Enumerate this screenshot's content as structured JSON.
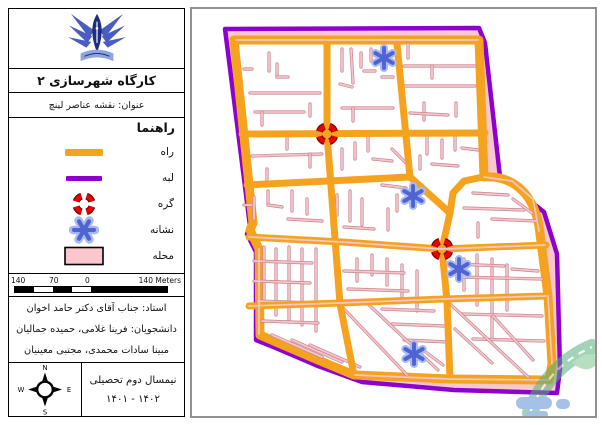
{
  "panel": {
    "title": "کارگاه شهرسازی ۲",
    "subtitle": "عنوان: نقشه عناصر لینچ",
    "legend": {
      "title": "راهنما",
      "items": [
        {
          "id": "road",
          "label": "راه"
        },
        {
          "id": "edge",
          "label": "لبه"
        },
        {
          "id": "node",
          "label": "گره"
        },
        {
          "id": "landmark",
          "label": "نشانه"
        },
        {
          "id": "district",
          "label": "محله"
        }
      ]
    },
    "scalebar": {
      "labels": [
        "140",
        "70",
        "0"
      ],
      "right_label": "140 Meters"
    },
    "credits": {
      "professor": "استاد: جناب آقای دکتر حامد اخوان",
      "students_line1": "دانشجویان: فرینا غلامی، حمیده جمالیان",
      "students_line2": "مبینا سادات محمدی، مجتبی معینیان"
    },
    "compass": {
      "n": "N",
      "s": "S",
      "e": "E",
      "w": "W"
    },
    "semester": {
      "line1": "نیمسال دوم تحصیلی",
      "line2": "۱۴۰۲ - ۱۴۰۱"
    }
  },
  "colors": {
    "road": "#F5A31F",
    "edge": "#8E00CE",
    "node_red": "#E60404",
    "node_dark": "#7A0000",
    "landmark_blue": "#4F63D2",
    "landmark_halo": "#A9BBF2",
    "district_pink": "#FAC7CD",
    "street_dark": "#C9848D",
    "street_light": "#F4C6CB",
    "logo_blue": "#4A5CC0",
    "logo_navy": "#1D2F7C",
    "logo_light": "#8FA3E0"
  },
  "map": {
    "boundary_d": "M 33,20 L 287,19 L 293,34 L 308,168 L 352,203 L 365,245 L 368,360 L 365,384 L 262,381 L 170,373 L 126,357 L 84,339 L 64,331 L 64,243 L 55,225 L 58,217 Z",
    "inner_d": "M 42,31 L 287,31 L 292,168 C 320,166 344,184 348,225 L 356,287 L 360,355 L 357,371 L 258,370 L 162,366 L 126,351 L 84,333 L 68,326 L 67,240 L 58,221 L 61,214 Z",
    "roads": [
      [
        [
          50,
          125
        ],
        [
          293,
          124
        ]
      ],
      [
        [
          135,
          35
        ],
        [
          135,
          125
        ],
        [
          148,
          295
        ],
        [
          162,
          366
        ]
      ],
      [
        [
          205,
          35
        ],
        [
          218,
          168
        ]
      ],
      [
        [
          55,
          176
        ],
        [
          218,
          168
        ]
      ],
      [
        [
          218,
          168
        ],
        [
          258,
          204
        ]
      ],
      [
        [
          291,
          168
        ],
        [
          272,
          172
        ],
        [
          261,
          184
        ],
        [
          258,
          204
        ]
      ],
      [
        [
          258,
          204
        ],
        [
          250,
          240
        ],
        [
          255,
          292
        ],
        [
          258,
          370
        ]
      ],
      [
        [
          57,
          228
        ],
        [
          150,
          233
        ],
        [
          250,
          240
        ],
        [
          354,
          236
        ]
      ],
      [
        [
          57,
          297
        ],
        [
          148,
          294
        ],
        [
          252,
          290
        ],
        [
          355,
          287
        ]
      ]
    ],
    "centerlines": [
      [
        [
          44,
          31
        ],
        [
          286,
          31
        ]
      ],
      [
        [
          57,
          228
        ],
        [
          150,
          233
        ],
        [
          250,
          240
        ],
        [
          353,
          236
        ]
      ],
      [
        [
          57,
          297
        ],
        [
          148,
          294
        ],
        [
          252,
          290
        ],
        [
          354,
          287
        ]
      ],
      [
        [
          357,
          371
        ],
        [
          258,
          370
        ],
        [
          163,
          366
        ]
      ],
      [
        [
          67,
          240
        ],
        [
          67,
          325
        ]
      ],
      [
        [
          292,
          168
        ],
        [
          320,
          172
        ],
        [
          341,
          190
        ],
        [
          347,
          222
        ]
      ],
      [
        [
          356,
          287
        ],
        [
          360,
          355
        ]
      ]
    ],
    "streets": [
      [
        77,
        44,
        77,
        62
      ],
      [
        85,
        55,
        85,
        68
      ],
      [
        85,
        68,
        96,
        68
      ],
      [
        58,
        84,
        128,
        84
      ],
      [
        63,
        103,
        112,
        103
      ],
      [
        70,
        103,
        70,
        116
      ],
      [
        118,
        95,
        118,
        107
      ],
      [
        52,
        60,
        60,
        60
      ],
      [
        150,
        40,
        150,
        62
      ],
      [
        159,
        40,
        161,
        74
      ],
      [
        169,
        44,
        169,
        58
      ],
      [
        172,
        62,
        183,
        62
      ],
      [
        179,
        40,
        179,
        52
      ],
      [
        150,
        99,
        201,
        99
      ],
      [
        161,
        99,
        161,
        112
      ],
      [
        190,
        68,
        201,
        68
      ],
      [
        148,
        75,
        160,
        78
      ],
      [
        212,
        57,
        283,
        57
      ],
      [
        212,
        77,
        283,
        77
      ],
      [
        216,
        35,
        216,
        49
      ],
      [
        240,
        57,
        240,
        69
      ],
      [
        232,
        94,
        232,
        111
      ],
      [
        218,
        104,
        256,
        106
      ],
      [
        264,
        94,
        264,
        107
      ],
      [
        60,
        147,
        130,
        145
      ],
      [
        95,
        128,
        95,
        140
      ],
      [
        118,
        145,
        118,
        158
      ],
      [
        75,
        160,
        75,
        172
      ],
      [
        52,
        196,
        62,
        196
      ],
      [
        62,
        188,
        62,
        210
      ],
      [
        76,
        182,
        76,
        196
      ],
      [
        76,
        196,
        90,
        198
      ],
      [
        100,
        182,
        100,
        202
      ],
      [
        96,
        210,
        130,
        212
      ],
      [
        115,
        190,
        115,
        205
      ],
      [
        150,
        140,
        150,
        160
      ],
      [
        163,
        134,
        163,
        150
      ],
      [
        145,
        186,
        145,
        206
      ],
      [
        158,
        182,
        158,
        212
      ],
      [
        170,
        190,
        170,
        216
      ],
      [
        181,
        150,
        200,
        152
      ],
      [
        176,
        128,
        176,
        142
      ],
      [
        190,
        176,
        214,
        179
      ],
      [
        205,
        186,
        205,
        202
      ],
      [
        152,
        218,
        182,
        220
      ],
      [
        196,
        200,
        196,
        221
      ],
      [
        200,
        140,
        214,
        154
      ],
      [
        235,
        128,
        235,
        145
      ],
      [
        250,
        131,
        250,
        149
      ],
      [
        263,
        128,
        263,
        141
      ],
      [
        270,
        139,
        286,
        141
      ],
      [
        240,
        155,
        266,
        157
      ],
      [
        228,
        147,
        228,
        160
      ],
      [
        272,
        199,
        332,
        201
      ],
      [
        281,
        184,
        316,
        186
      ],
      [
        300,
        210,
        345,
        212
      ],
      [
        286,
        214,
        286,
        228
      ],
      [
        321,
        190,
        340,
        204
      ],
      [
        72,
        238,
        72,
        296
      ],
      [
        84,
        240,
        84,
        306
      ],
      [
        97,
        238,
        97,
        312
      ],
      [
        110,
        240,
        110,
        316
      ],
      [
        124,
        240,
        124,
        322
      ],
      [
        62,
        252,
        120,
        254
      ],
      [
        62,
        272,
        118,
        274
      ],
      [
        66,
        292,
        122,
        294
      ],
      [
        70,
        312,
        126,
        314
      ],
      [
        80,
        326,
        130,
        348
      ],
      [
        100,
        331,
        150,
        353
      ],
      [
        118,
        336,
        168,
        358
      ],
      [
        150,
        298,
        215,
        366
      ],
      [
        165,
        250,
        165,
        272
      ],
      [
        180,
        246,
        180,
        266
      ],
      [
        195,
        250,
        195,
        276
      ],
      [
        210,
        256,
        210,
        292
      ],
      [
        225,
        262,
        225,
        302
      ],
      [
        152,
        262,
        212,
        264
      ],
      [
        156,
        280,
        216,
        282
      ],
      [
        190,
        300,
        242,
        302
      ],
      [
        200,
        315,
        252,
        317
      ],
      [
        212,
        331,
        256,
        333
      ],
      [
        231,
        341,
        251,
        356
      ],
      [
        176,
        295,
        246,
        361
      ],
      [
        272,
        250,
        272,
        281
      ],
      [
        285,
        246,
        285,
        296
      ],
      [
        300,
        250,
        300,
        331
      ],
      [
        315,
        256,
        315,
        301
      ],
      [
        265,
        268,
        350,
        270
      ],
      [
        270,
        305,
        350,
        307
      ],
      [
        281,
        330,
        352,
        332
      ],
      [
        263,
        320,
        300,
        354
      ],
      [
        301,
        307,
        341,
        351
      ],
      [
        255,
        292,
        336,
        368
      ],
      [
        320,
        260,
        346,
        262
      ],
      [
        260,
        255,
        312,
        257
      ]
    ],
    "nodes": [
      [
        135,
        125
      ],
      [
        250,
        240
      ]
    ],
    "landmarks": [
      [
        192,
        49
      ],
      [
        221,
        187
      ],
      [
        267,
        260
      ],
      [
        222,
        345
      ]
    ]
  }
}
